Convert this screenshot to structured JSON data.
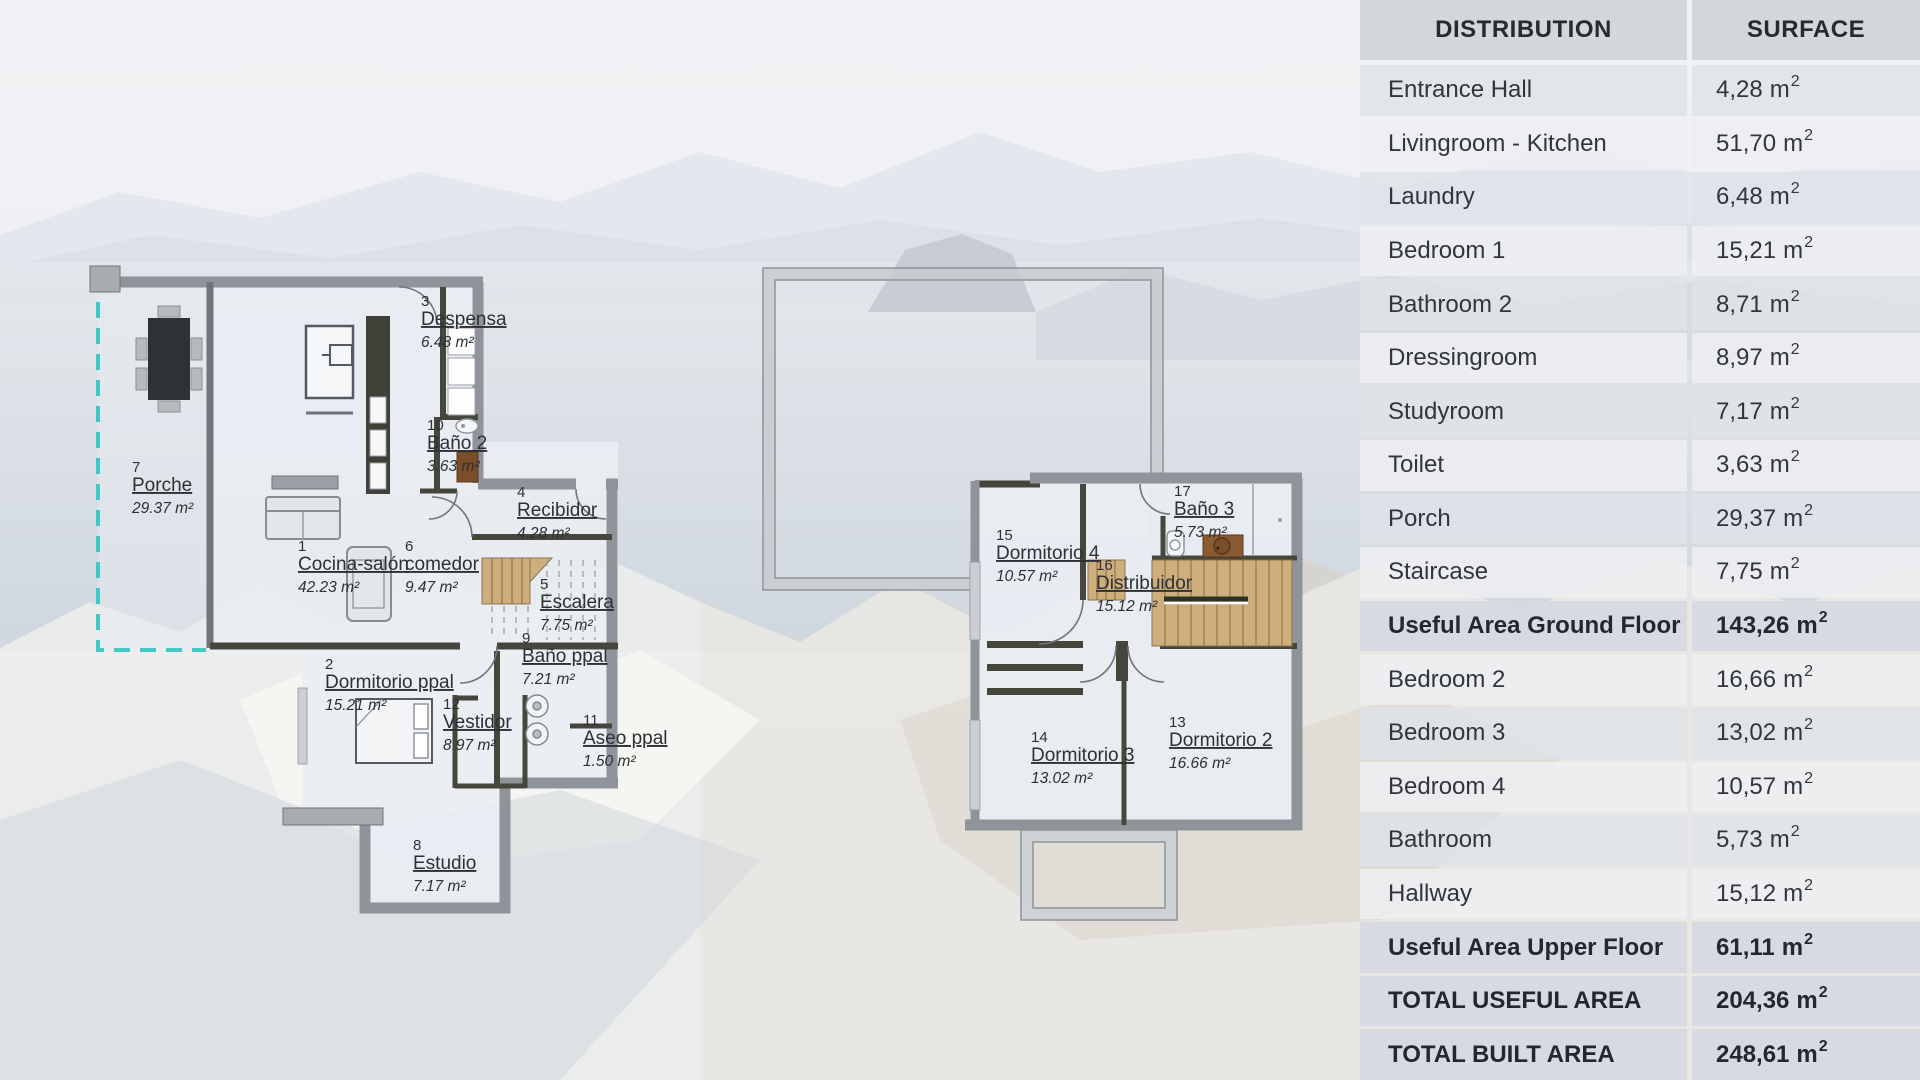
{
  "table": {
    "columns": [
      "DISTRIBUTION",
      "SURFACE"
    ],
    "unit": {
      "base": "m",
      "exp": "2"
    },
    "rows": [
      {
        "label": "Entrance Hall",
        "value": "4,28",
        "emphasis": false
      },
      {
        "label": "Livingroom - Kitchen",
        "value": "51,70",
        "emphasis": false
      },
      {
        "label": "Laundry",
        "value": "6,48",
        "emphasis": false
      },
      {
        "label": "Bedroom 1",
        "value": "15,21",
        "emphasis": false
      },
      {
        "label": "Bathroom 2",
        "value": "8,71",
        "emphasis": false
      },
      {
        "label": "Dressingroom",
        "value": "8,97",
        "emphasis": false
      },
      {
        "label": "Studyroom",
        "value": "7,17",
        "emphasis": false
      },
      {
        "label": "Toilet",
        "value": "3,63",
        "emphasis": false
      },
      {
        "label": "Porch",
        "value": "29,37",
        "emphasis": false
      },
      {
        "label": "Staircase",
        "value": "7,75",
        "emphasis": false
      },
      {
        "label": "Useful Area Ground Floor",
        "value": "143,26",
        "emphasis": true
      },
      {
        "label": "Bedroom 2",
        "value": "16,66",
        "emphasis": false
      },
      {
        "label": "Bedroom 3",
        "value": "13,02",
        "emphasis": false
      },
      {
        "label": "Bedroom 4",
        "value": "10,57",
        "emphasis": false
      },
      {
        "label": "Bathroom",
        "value": "5,73",
        "emphasis": false
      },
      {
        "label": "Hallway",
        "value": "15,12",
        "emphasis": false
      },
      {
        "label": "Useful Area Upper Floor",
        "value": "61,11",
        "emphasis": true
      },
      {
        "label": "TOTAL USEFUL AREA",
        "value": "204,36",
        "emphasis": true
      },
      {
        "label": "TOTAL BUILT AREA",
        "value": "248,61",
        "emphasis": true
      }
    ]
  },
  "plans": {
    "ground": {
      "title": "ground-floor-plan",
      "rooms": [
        {
          "id": "cocina",
          "number": "1",
          "name": "Cocina-salón",
          "area": "42.23 m²"
        },
        {
          "id": "dormppal",
          "number": "2",
          "name": "Dormitorio ppal",
          "area": "15.21 m²"
        },
        {
          "id": "despensa",
          "number": "3",
          "name": "Despensa",
          "area": "6.48 m²"
        },
        {
          "id": "recibidor",
          "number": "4",
          "name": "Recibidor",
          "area": "4.28 m²"
        },
        {
          "id": "escalera",
          "number": "5",
          "name": "Escalera",
          "area": "7.75 m²"
        },
        {
          "id": "comedor",
          "number": "6",
          "name": "comedor",
          "area": "9.47 m²"
        },
        {
          "id": "porche",
          "number": "7",
          "name": "Porche",
          "area": "29.37 m²"
        },
        {
          "id": "estudio",
          "number": "8",
          "name": "Estudio",
          "area": "7.17 m²"
        },
        {
          "id": "banoppal",
          "number": "9",
          "name": "Baño ppal",
          "area": "7.21 m²"
        },
        {
          "id": "bano2",
          "number": "10",
          "name": "Baño 2",
          "area": "3.63 m²"
        },
        {
          "id": "aseoppal",
          "number": "11",
          "name": "Aseo ppal",
          "area": "1.50 m²"
        },
        {
          "id": "vestidor",
          "number": "12",
          "name": "Vestidor",
          "area": "8.97 m²"
        }
      ]
    },
    "upper": {
      "title": "upper-floor-plan",
      "rooms": [
        {
          "id": "dorm2",
          "number": "13",
          "name": "Dormitorio 2",
          "area": "16.66 m²"
        },
        {
          "id": "dorm3",
          "number": "14",
          "name": "Dormitorio 3",
          "area": "13.02 m²"
        },
        {
          "id": "dorm4",
          "number": "15",
          "name": "Dormitorio 4",
          "area": "10.57 m²"
        },
        {
          "id": "distribuidor",
          "number": "16",
          "name": "Distribuidor",
          "area": "15.12 m²"
        },
        {
          "id": "bano3",
          "number": "17",
          "name": "Baño 3",
          "area": "5.73 m²"
        }
      ]
    }
  },
  "colors": {
    "porch_dashed_accent": "#3FC8C5",
    "exterior_wall": "#8E949A",
    "interior_wall": "#45463C",
    "stairs_wood": "#CFAE7D",
    "bath_wood": "#8A5A33",
    "table_header_bg": "#D1D4DA",
    "table_text": "#32363C",
    "floor_fill": "#E9EDF2"
  }
}
